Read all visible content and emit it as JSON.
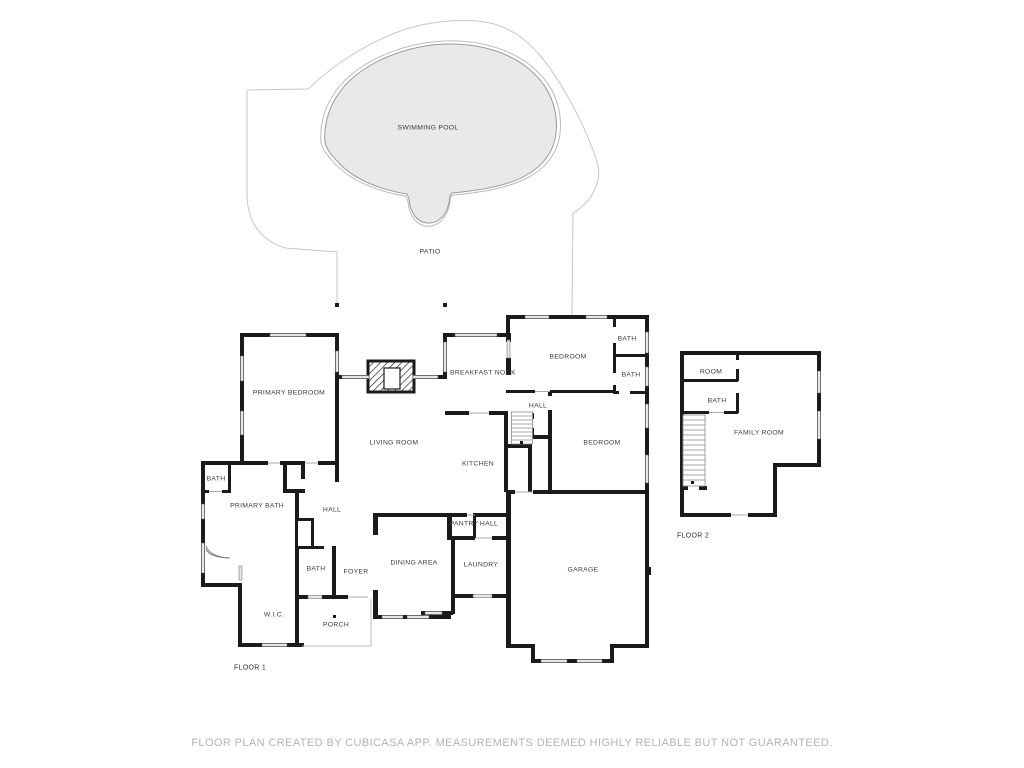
{
  "site": {
    "swimming_pool": "SWIMMING POOL",
    "patio": "PATIO"
  },
  "floor1": {
    "name": "FLOOR 1",
    "primary_bedroom": "PRIMARY BEDROOM",
    "breakfast_nook": "BREAKFAST NOOK",
    "bedroom_north": "BEDROOM",
    "bath_ne1": "BATH",
    "bath_ne2": "BATH",
    "hall_north": "HALL",
    "living_room": "LIVING ROOM",
    "kitchen": "KITCHEN",
    "bedroom_east": "BEDROOM",
    "bath_west": "BATH",
    "primary_bath": "PRIMARY BATH",
    "hall_west": "HALL",
    "pantry": "PANTRY",
    "hall_south": "HALL",
    "dining_area": "DINING AREA",
    "laundry": "LAUNDRY",
    "foyer": "FOYER",
    "bath_center": "BATH",
    "wic": "W.I.C.",
    "porch": "PORCH",
    "garage": "GARAGE"
  },
  "floor2": {
    "name": "FLOOR 2",
    "room": "ROOM",
    "bath": "BATH",
    "family_room": "FAMILY ROOM"
  },
  "footer": {
    "disclaimer": "FLOOR PLAN CREATED BY CUBICASA APP. MEASUREMENTS DEEMED HIGHLY RELIABLE BUT NOT GUARANTEED."
  },
  "colors": {
    "wall": "#1b1b1b",
    "window_fill": "#e7e7e7",
    "pool_fill": "#e9e9e9",
    "pool_stroke": "#9a9a9a",
    "patio_stroke": "#c7c7c7",
    "label_text": "#3b3b3b",
    "footer_text": "#b3b3b3"
  }
}
